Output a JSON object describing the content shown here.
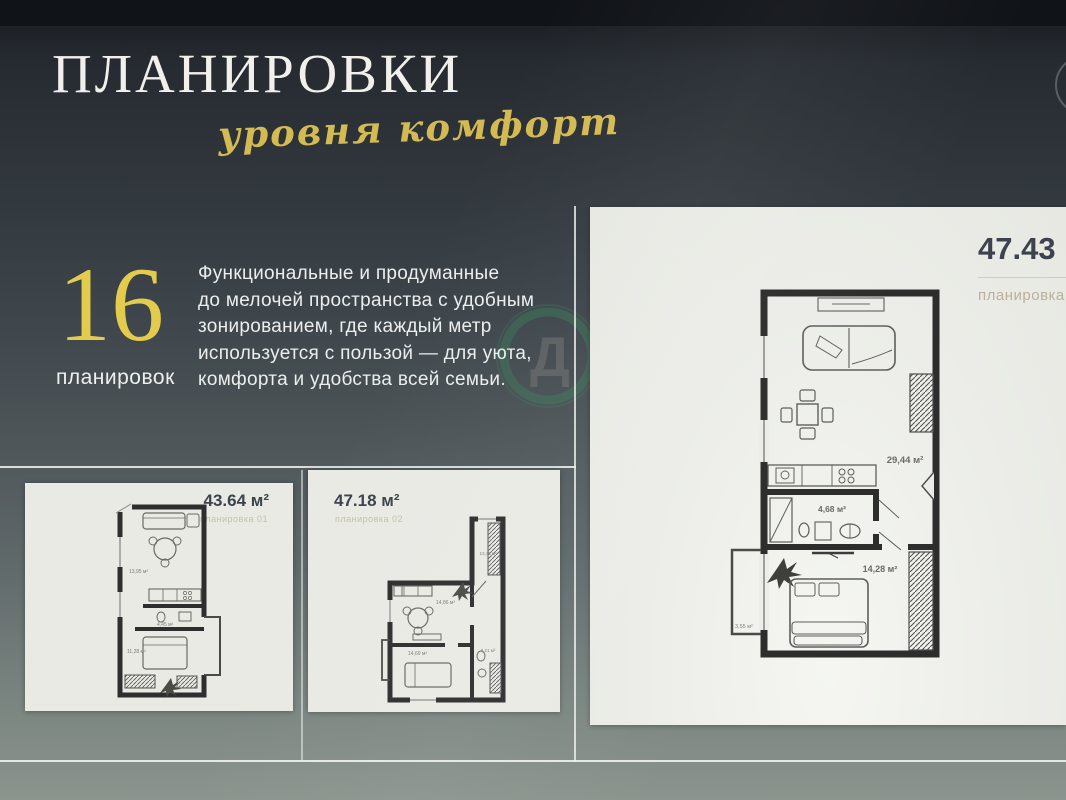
{
  "header": {
    "title": "ПЛАНИРОВКИ",
    "script_subtitle": "уровня комфорт"
  },
  "stat": {
    "number": "16",
    "label": "планировок"
  },
  "description": {
    "lines": [
      "Функциональные и продуманные",
      "до мелочей пространства с удобным",
      "зонированием, где каждый метр",
      "используется с пользой — для уюта,",
      "комфорта и удобства всей семьи."
    ]
  },
  "watermark": {
    "letter": "Д",
    "color": "#37815a"
  },
  "colors": {
    "gold_accent": "#e3cb4d",
    "plan_label_olive": "#b9b299",
    "area_title_dark": "#3c434e"
  },
  "cards": [
    {
      "area": "43.64 м²",
      "plan_label": "планировка 01",
      "room_labels": [
        "13,95 м²",
        "4,45 м²",
        "11,28 м²"
      ]
    },
    {
      "area": "47.18 м²",
      "plan_label": "планировка 02",
      "room_labels": [
        "14,86 м²",
        "13,32 м²",
        "14,69 м²",
        "3,21 м²"
      ]
    },
    {
      "area": "47.43 м²",
      "plan_label": "планировка 03",
      "room_labels": [
        "29,44 м²",
        "4,68 м²",
        "14,28 м²",
        "3,55 м²"
      ]
    }
  ]
}
